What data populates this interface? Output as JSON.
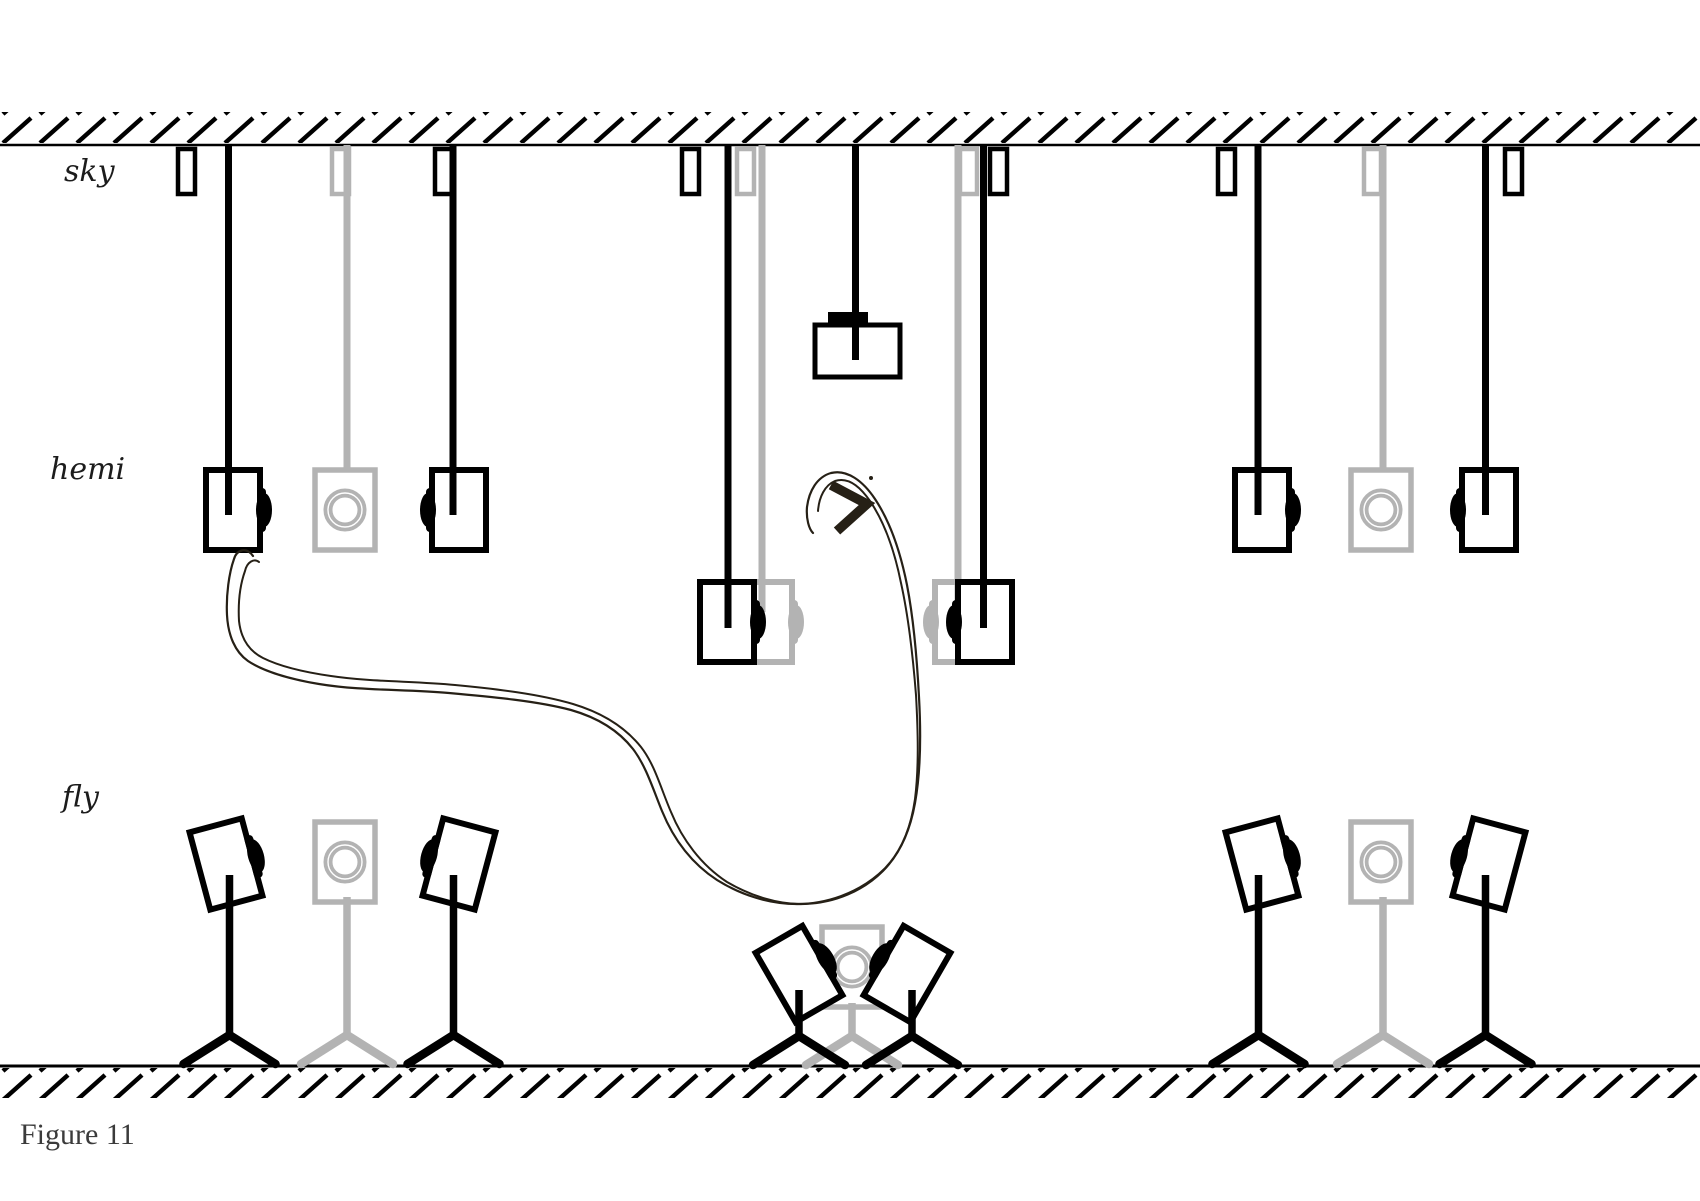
{
  "figure": {
    "caption": "Figure 11",
    "labels": {
      "sky": "sky",
      "hemi": "hemi",
      "fly": "fly"
    }
  },
  "colors": {
    "equipment_black": "#000000",
    "equipment_gray": "#b3b3b3",
    "sketch_line": "#262016",
    "label_text": "#1c1c1c",
    "caption_text": "#3b3b3b",
    "background": "#ffffff"
  }
}
